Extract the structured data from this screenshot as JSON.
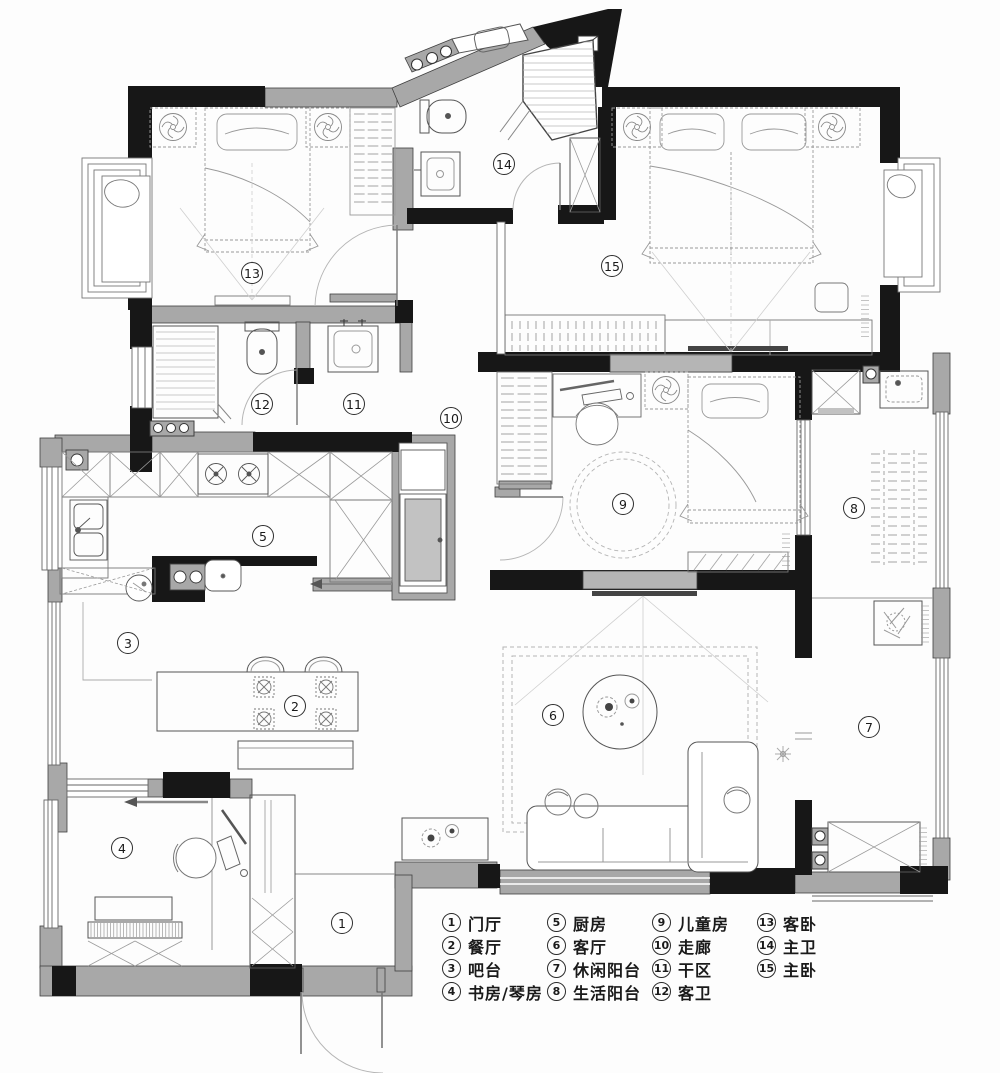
{
  "plan": {
    "rooms": [
      {
        "num": "1",
        "label": "门厅",
        "x": 342,
        "y": 923
      },
      {
        "num": "2",
        "label": "餐厅",
        "x": 295,
        "y": 706
      },
      {
        "num": "3",
        "label": "吧台",
        "x": 128,
        "y": 643
      },
      {
        "num": "4",
        "label": "书房/琴房",
        "x": 122,
        "y": 848
      },
      {
        "num": "5",
        "label": "厨房",
        "x": 263,
        "y": 536
      },
      {
        "num": "6",
        "label": "客厅",
        "x": 553,
        "y": 715
      },
      {
        "num": "7",
        "label": "休闲阳台",
        "x": 869,
        "y": 727
      },
      {
        "num": "8",
        "label": "生活阳台",
        "x": 854,
        "y": 508
      },
      {
        "num": "9",
        "label": "儿童房",
        "x": 623,
        "y": 504
      },
      {
        "num": "10",
        "label": "走廊",
        "x": 451,
        "y": 418
      },
      {
        "num": "11",
        "label": "干区",
        "x": 354,
        "y": 404
      },
      {
        "num": "12",
        "label": "客卫",
        "x": 262,
        "y": 404
      },
      {
        "num": "13",
        "label": "客卧",
        "x": 252,
        "y": 273
      },
      {
        "num": "14",
        "label": "主卫",
        "x": 504,
        "y": 164
      },
      {
        "num": "15",
        "label": "主卧",
        "x": 612,
        "y": 266
      }
    ],
    "legend": {
      "per_column": 4,
      "column_lefts": [
        442,
        547,
        652,
        757
      ]
    },
    "colors": {
      "wall_black": "#171717",
      "wall_gray": "#a8a8a8",
      "line": "#555555"
    }
  }
}
